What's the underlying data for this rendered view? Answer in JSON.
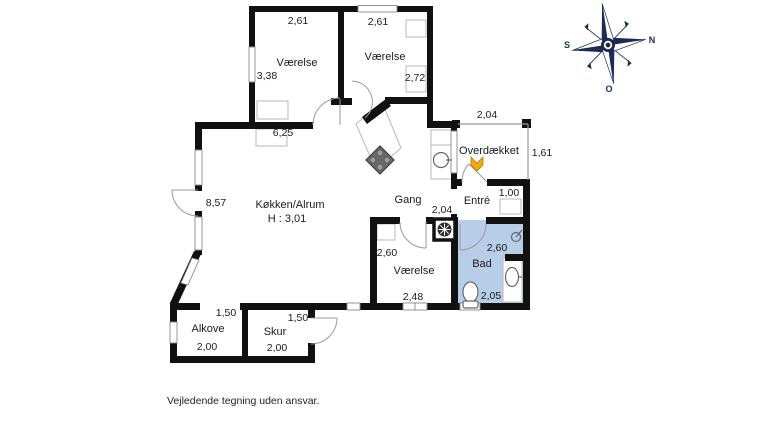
{
  "plan": {
    "rooms": {
      "vaerelse_nw": {
        "name": "Værelse",
        "dim_top": "2,61",
        "dim_left": "3,38"
      },
      "vaerelse_ne": {
        "name": "Værelse",
        "dim_top": "2,61",
        "dim_right": "2,72"
      },
      "koekken_alrum": {
        "name": "Køkken/Alrum",
        "ceiling_height": "H : 3,01",
        "dim_top": "6,25",
        "dim_left": "8,57"
      },
      "gang": {
        "name": "Gang",
        "dim": "2,04"
      },
      "overdaekket": {
        "name": "Overdækket",
        "dim_top": "2,04",
        "dim_right": "1,61"
      },
      "entre": {
        "name": "Entré",
        "dim": "1,00"
      },
      "bad": {
        "name": "Bad",
        "dim_top": "2,60",
        "dim_bottom": "2,05"
      },
      "vaerelse_s": {
        "name": "Værelse",
        "dim_left": "2,60",
        "dim_bottom": "2,48"
      },
      "alkove": {
        "name": "Alkove",
        "dim_top": "1,50",
        "dim_bottom": "2,00"
      },
      "skur": {
        "name": "Skur",
        "dim_top": "1,50",
        "dim_bottom": "2,00"
      }
    },
    "compass": {
      "n": "N",
      "s": "S",
      "e": "O"
    },
    "footer": "Vejledende tegning uden ansvar."
  },
  "colors": {
    "wall": "#111111",
    "bad_fill": "#b8cde8",
    "compass": "#1d2b50",
    "arrow": "#f2a71b",
    "window_stroke": "#8a8a8a",
    "arc_stroke": "#9a9a9a"
  }
}
